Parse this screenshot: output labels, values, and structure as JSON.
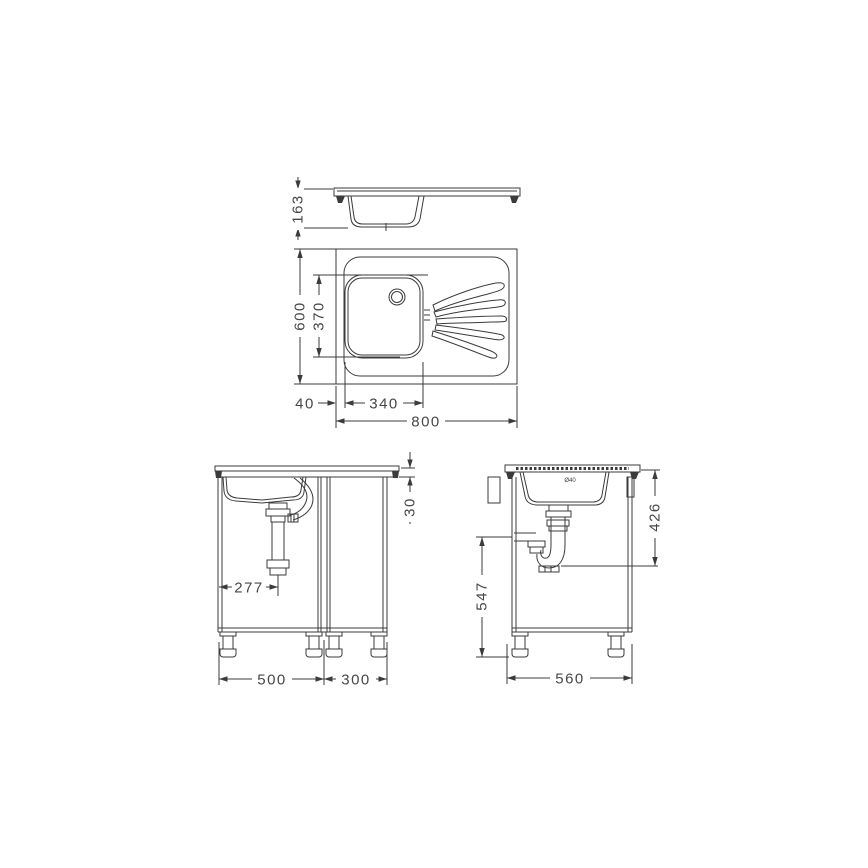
{
  "colors": {
    "background": "#ffffff",
    "line": "#3b3b3b",
    "text": "#474747"
  },
  "views": {
    "profile": {
      "description": "sink top cross-section",
      "dims": {
        "bowl_height": "163"
      }
    },
    "plan": {
      "description": "sink plan view with bowl and drainboard",
      "dims": {
        "overall_depth": "600",
        "bowl_depth": "370",
        "bowl_offset_left": "40",
        "bowl_width": "340",
        "overall_width": "800"
      }
    },
    "front": {
      "description": "cabinet front elevation",
      "dims": {
        "drain_center_offset": "277",
        "worktop_edge_height": "30",
        "left_cabinet_width": "500",
        "right_cabinet_width": "300"
      }
    },
    "side": {
      "description": "cabinet side elevation",
      "bowl_mark": "Ø40",
      "dims": {
        "drain_outlet_drop": "426",
        "waste_outlet_height": "547",
        "cabinet_depth": "560"
      }
    }
  }
}
